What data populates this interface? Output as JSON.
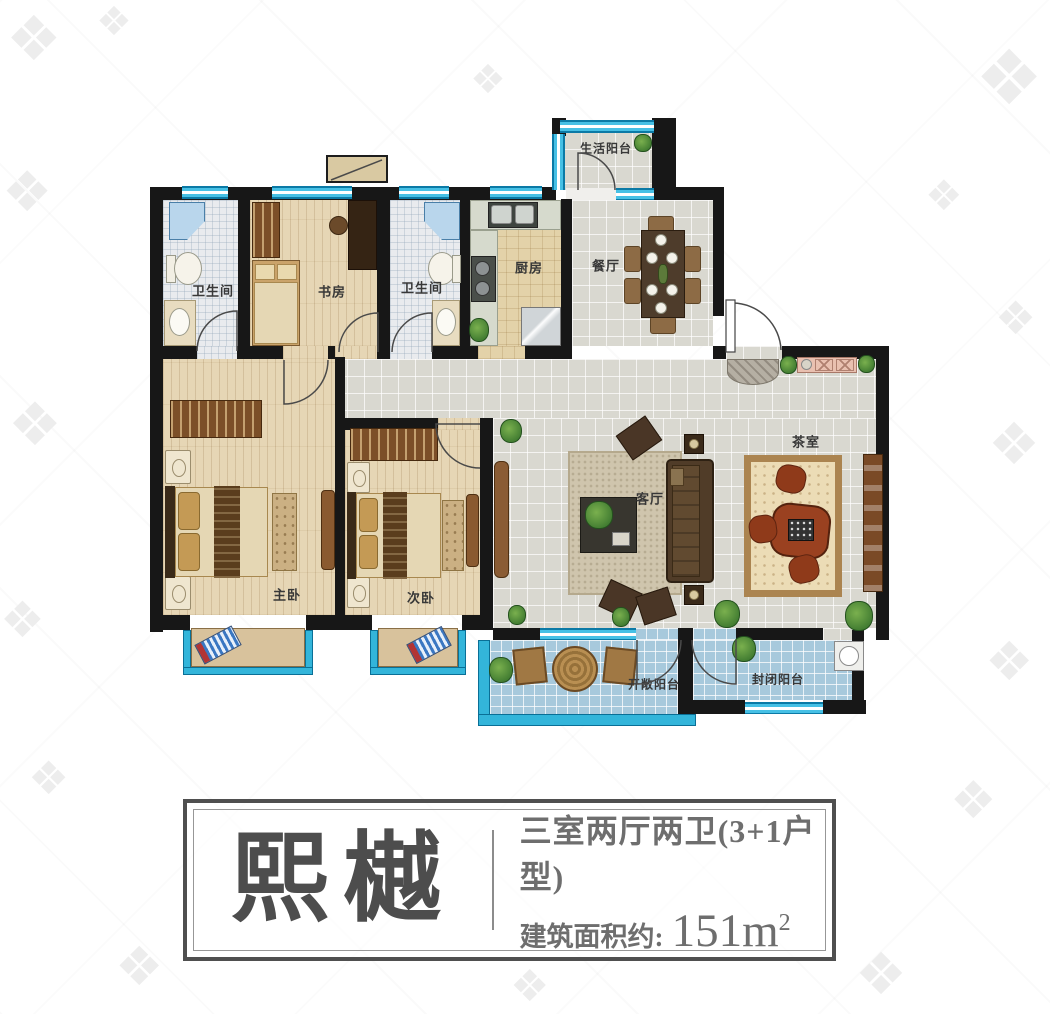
{
  "watermark": {
    "glyph": "❖"
  },
  "plan": {
    "rooms": {
      "life_balcony": "生活阳台",
      "bath1": "卫生间",
      "study": "书房",
      "bath2": "卫生间",
      "kitchen": "厨房",
      "dining": "餐厅",
      "tea_room": "茶室",
      "living": "客厅",
      "master": "主卧",
      "second": "次卧",
      "open_balcony": "开敞阳台",
      "closed_balcony": "封闭阳台"
    }
  },
  "title_block": {
    "name": "熙樾",
    "layout_line": "三室两厅两卫(3+1户型)",
    "area_label": "建筑面积约:",
    "area_value": "151m",
    "area_superscript": "2"
  },
  "colors": {
    "wall": "#171717",
    "window_cyan": "#46c0e5",
    "balcony_wall_cyan": "#33b5da",
    "wood_floor": "#e6d6b5",
    "gray_tile": "#d9d8d0",
    "balcony_tile": "#a7c9dc",
    "title_text": "#4d4d4d"
  }
}
